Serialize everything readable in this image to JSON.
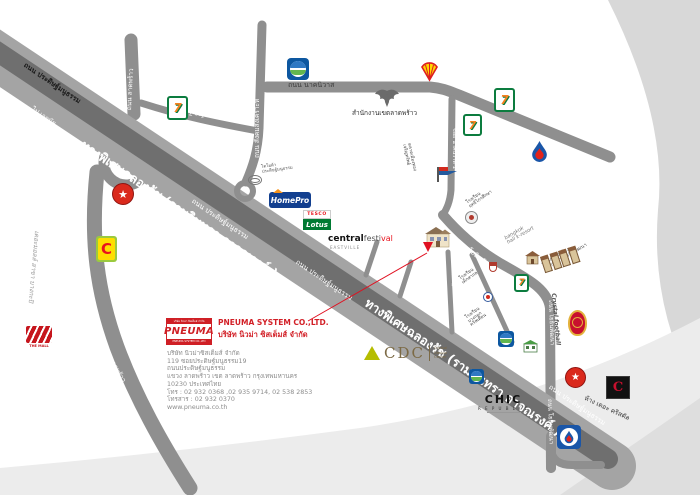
{
  "colors": {
    "accent_red": "#d21f26",
    "road_gray": "#8f8f8f",
    "highway_dark": "#6f6f6f",
    "swoosh_gray": "#d8d8d8"
  },
  "company": {
    "logo": {
      "top_text": "บริษัท นิวม่า ซิสเต็มส์ จำกัด",
      "name": "PNEUMA",
      "bottom_text": "PNEUMA SYSTEM CO.,LTD"
    },
    "heading_en": "PNEUMA SYSTEM CO.,LTD.",
    "heading_th": "บริษัท นิวม่า ซิสเต็มส์ จำกัด",
    "address": [
      "บริษัท นิวม่าซิสเต็มส์ จำกัด",
      "119 ซอยประดิษฐ์มนูธรรม19",
      "ถนนประดิษฐ์มนูธรรม",
      "แขวง ลาดพร้าว เขต ลาดพร้าว กรุงเทพมหานคร",
      "10230 ประเทศไทย",
      "โทร : 02 932 0368 ,02 935 9714, 02 538 2853",
      "โทรสาร : 02 932 0370",
      "www.pneuma.co.th"
    ]
  },
  "roads": {
    "expressway_big": "ทางพิเศษฉลองรัช (รามอินทรา อาจณรงค์ )",
    "pradit": "ถนน ประดิษฐ์มนูธรรม",
    "to_ekamai": "ไป เอกมัย",
    "ladprao": "ถนน ลาดพร้าว",
    "ladprao71": "ซอย ลาดพร้าว 71",
    "sangkhom": "ถนน สังคมสงเคราะห์",
    "nakniwat": "ถนน นาคนิวาส",
    "nakniwat_soi1": "ซอย นาคนิวาส 1",
    "yothin": "ถนน โยธินพัฒนา",
    "soi_pradit15": "ซอย ประดิษฐ์มนูธรรม 15",
    "soi_pradit19": "ซอย ประดิษฐ์มนูธรรม 19",
    "to_the_mall": "เดอะมอลล์ สาขา บางกะปิ"
  },
  "places": {
    "district_office": "สำนักงานเขตลาดพร้าว",
    "toyota": {
      "l1": "โตโยต้า",
      "l2": "ประดิษฐ์มนูธรรม"
    },
    "market": {
      "l1": "ตลาดเมืองทอง",
      "l2": "เจริญทรัพย์"
    },
    "school_ritthikrai": {
      "l1": "โรงเรียน",
      "l2": "ฤทธิไกรศึกษา"
    },
    "school_deksakon": {
      "l1": "โรงเรียน",
      "l2": "เด็กสากล"
    },
    "school_bkk_christian": {
      "l1": "โรงเรียน",
      "l2": "บางกอก",
      "l3": "คริสเตียน"
    },
    "bangkok_resort": {
      "l1": "bangkok",
      "l2": "hall k-resort"
    },
    "baan_klang_muang": {
      "l1": "บ้านกลางเมือง",
      "l2": "ลาดพร้าว-โยธินพัฒนา"
    },
    "crystal_football": "Crystal football",
    "the_crystal": "ห้าง เดอะ คริสตัล"
  },
  "logos": {
    "homepro": "HomePro",
    "tesco": "TESCO",
    "lotus": "Lotus",
    "central": "central",
    "festival": "festi",
    "festival_red": "val",
    "eastville": "EASTVILLE",
    "cdc": "CDC",
    "cdc_sub": {
      "l1": "Crystal",
      "l2": "Design",
      "l3": "Center"
    },
    "chic": "CHIC",
    "republic": "R E P U B L I C",
    "bigc": "C",
    "seven": "7",
    "the_mall": "THE MALL",
    "the_crystal_c": "C"
  },
  "icons": {
    "caltex_star": "★",
    "shell": "shell-scallop",
    "bangchak": "leaf-globe",
    "ptt": "flame-drop",
    "seven_eleven": "7-eleven-stripes",
    "garuda": "garuda-emblem",
    "market_flag": "pennant-flag",
    "company_building": "office-building",
    "red_arrow": "location-arrow"
  }
}
